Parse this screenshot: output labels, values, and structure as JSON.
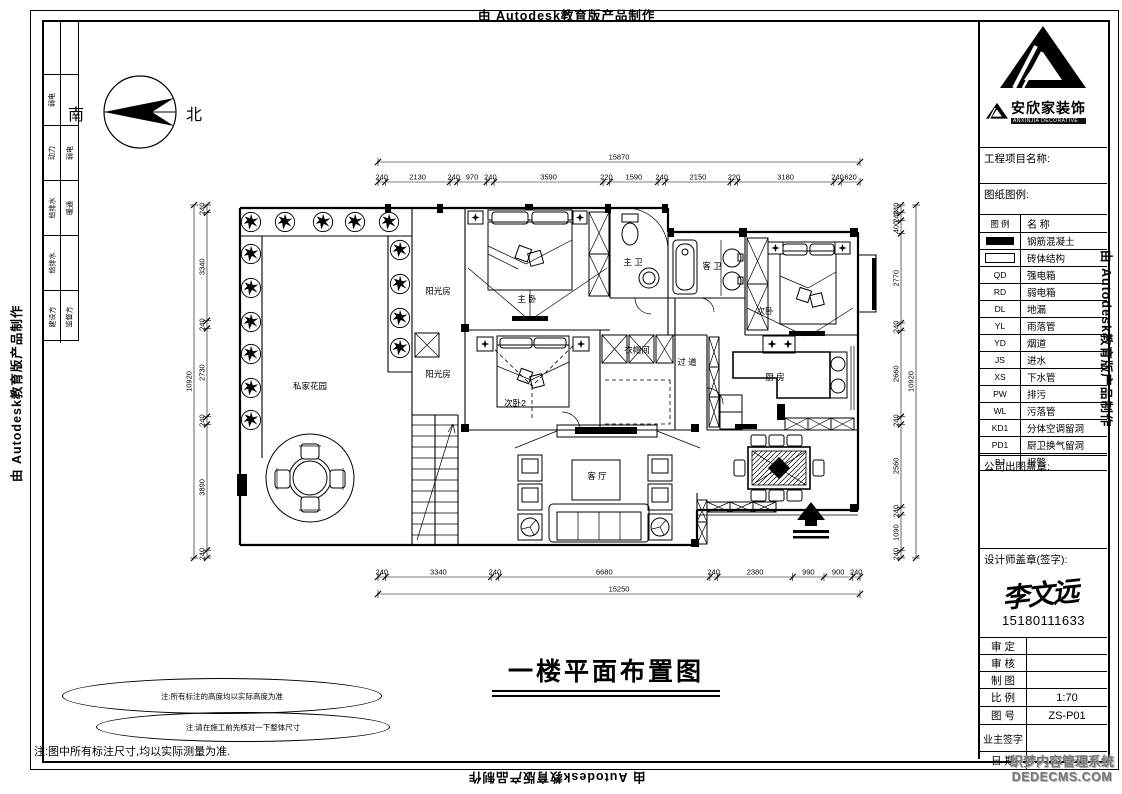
{
  "watermarks": {
    "autodesk": "由 Autodesk教育版产品制作",
    "cms_line1": "织梦内容管理系统",
    "cms_line2": "DEDECMS.COM"
  },
  "compass": {
    "south": "南",
    "north": "北"
  },
  "sign_strip": {
    "rows": [
      [
        "",
        ""
      ],
      [
        "弱电",
        ""
      ],
      [
        "动力",
        "弱电"
      ],
      [
        "给排水",
        "暖通"
      ],
      [
        "给排水",
        ""
      ],
      [
        "建设方",
        "监督方"
      ]
    ]
  },
  "title_block": {
    "brand": {
      "name": "安欣家装饰",
      "subtitle": "ANXINJIA DECORATIVE"
    },
    "project_label": "工程项目名称:",
    "legend_label": "图纸图例:",
    "legend": {
      "headers": [
        "图 例",
        "名  称"
      ],
      "rows": [
        {
          "code": "",
          "name": "钢筋混凝土"
        },
        {
          "code": "",
          "name": "砖体结构"
        },
        {
          "code": "QD",
          "name": "强电箱"
        },
        {
          "code": "RD",
          "name": "弱电箱"
        },
        {
          "code": "DL",
          "name": "地漏"
        },
        {
          "code": "YL",
          "name": "雨落管"
        },
        {
          "code": "YD",
          "name": "烟道"
        },
        {
          "code": "JS",
          "name": "进水"
        },
        {
          "code": "XS",
          "name": "下水管"
        },
        {
          "code": "PW",
          "name": "排污"
        },
        {
          "code": "WL",
          "name": "污落管"
        },
        {
          "code": "KD1",
          "name": "分体空调留洞"
        },
        {
          "code": "PD1",
          "name": "厨卫换气留洞"
        },
        {
          "code": "BJ",
          "name": "报警"
        }
      ]
    },
    "company_seal_label": "公司出图盖章:",
    "designer_seal_label": "设计师盖章(签字):",
    "designer_signature": "李文远",
    "designer_phone": "15180111633",
    "info_rows": [
      {
        "label": "审 定",
        "value": ""
      },
      {
        "label": "审 核",
        "value": ""
      },
      {
        "label": "制 图",
        "value": ""
      },
      {
        "label": "比 例",
        "value": "1:70"
      },
      {
        "label": "图 号",
        "value": "ZS-P01"
      },
      {
        "label": "业主签字",
        "value": ""
      },
      {
        "label": "日 期",
        "value": ""
      }
    ]
  },
  "plan": {
    "rooms": {
      "garden": "私家花园",
      "sunroom1": "阳光房",
      "sunroom2": "阳光房",
      "master": "主 卧",
      "masterBath": "主 卫",
      "guestBath": "客 卫",
      "bedroom2": "次卧",
      "bedroom3": "次卧2",
      "closet": "衣帽间",
      "hallway": "过 道",
      "kitchen": "厨 房",
      "living": "客 厅"
    },
    "dims": {
      "top": {
        "total": "15870",
        "segments": [
          "240",
          "2130",
          "240",
          "970",
          "240",
          "3590",
          "220",
          "1590",
          "240",
          "2150",
          "220",
          "3180",
          "240",
          "620"
        ]
      },
      "bottom": {
        "total": "15250",
        "segments": [
          "240",
          "3340",
          "240",
          "6680",
          "240",
          "2380",
          "990",
          "900",
          "240"
        ]
      },
      "left": {
        "total": "10920",
        "segments": [
          "240",
          "3340",
          "240",
          "2730",
          "240",
          "3890",
          "240"
        ]
      },
      "right": {
        "total": "10920",
        "segments": [
          "240",
          "240",
          "400",
          "2770",
          "240",
          "2660",
          "240",
          "2560",
          "240",
          "1090",
          "240"
        ]
      }
    }
  },
  "footer": {
    "title": "一楼平面布置图",
    "note1": "注:所有标注的高度均以实际高度为准",
    "note2": "注:请在施工前先核对一下整体尺寸",
    "note3": "注:图中所有标注尺寸,均以实际测量为准."
  }
}
